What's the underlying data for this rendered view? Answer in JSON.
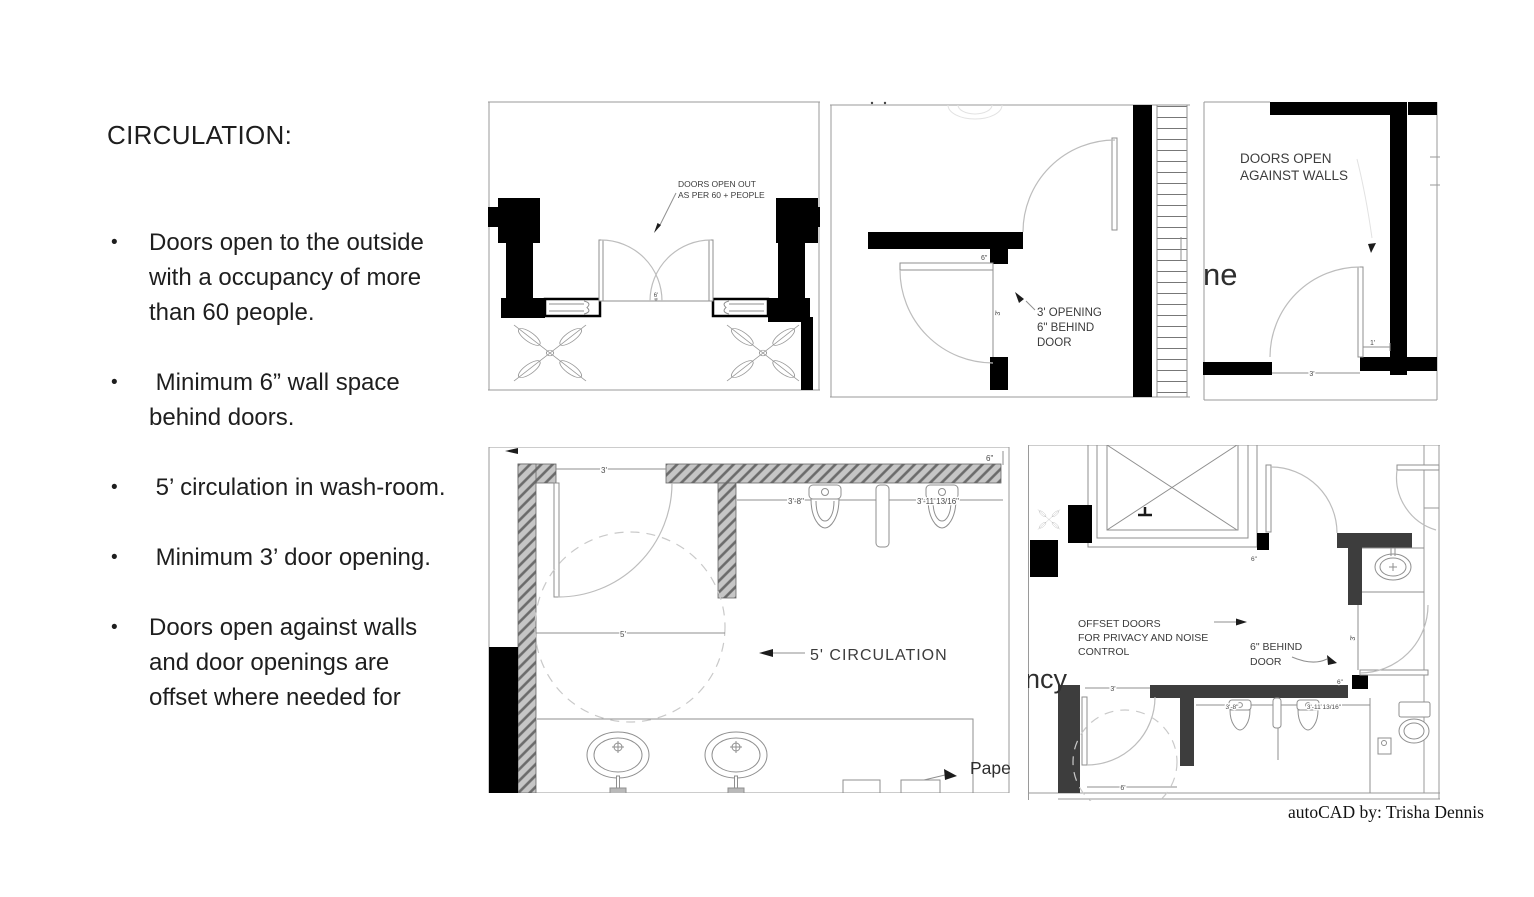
{
  "sidebar": {
    "heading": "CIRCULATION:",
    "bullet_char": "•",
    "bullets": [
      "Doors open to the outside with a occupancy of more than 60 people.",
      " Minimum 6” wall space behind doors.",
      " 5’ circulation in wash-room.",
      " Minimum 3’ door opening.",
      "Doors open against walls and door openings are offset where needed for"
    ]
  },
  "credit": "autoCAD by: Trisha Dennis",
  "entrance": {
    "note1": "DOORS OPEN OUT",
    "note2": "AS PER 60 + PEOPLE",
    "dim_center": "6'"
  },
  "opening": {
    "note1": "3' OPENING",
    "note2": "6\" BEHIND",
    "note3": "DOOR",
    "dim_wall": "6\"",
    "dim_opening": "3'"
  },
  "against": {
    "note1": "DOORS OPEN",
    "note2": "AGAINST WALLS",
    "partial": "ne",
    "dim_one": "1'",
    "dim_three": "3'"
  },
  "washroom": {
    "label": "5' CIRCULATION",
    "dim_door": "3'",
    "dim_circle": "5'",
    "dim_wall": "6\"",
    "dim_u1": "3'-8\"",
    "dim_u2": "3'-11 13/16\"",
    "paper": "Pape"
  },
  "offset": {
    "n1a": "OFFSET DOORS",
    "n1b": "FOR PRIVACY AND NOISE",
    "n1c": "CONTROL",
    "n2a": "6\" BEHIND",
    "n2b": "DOOR",
    "partial": "ncy",
    "dim_top": "6\"",
    "dim_door3": "3'",
    "dim_door6": "6\"",
    "dim_left3": "3'",
    "dim_left6": "6'",
    "dim_u1": "3'-8\"",
    "dim_u2": "3'-11 13/16\""
  }
}
